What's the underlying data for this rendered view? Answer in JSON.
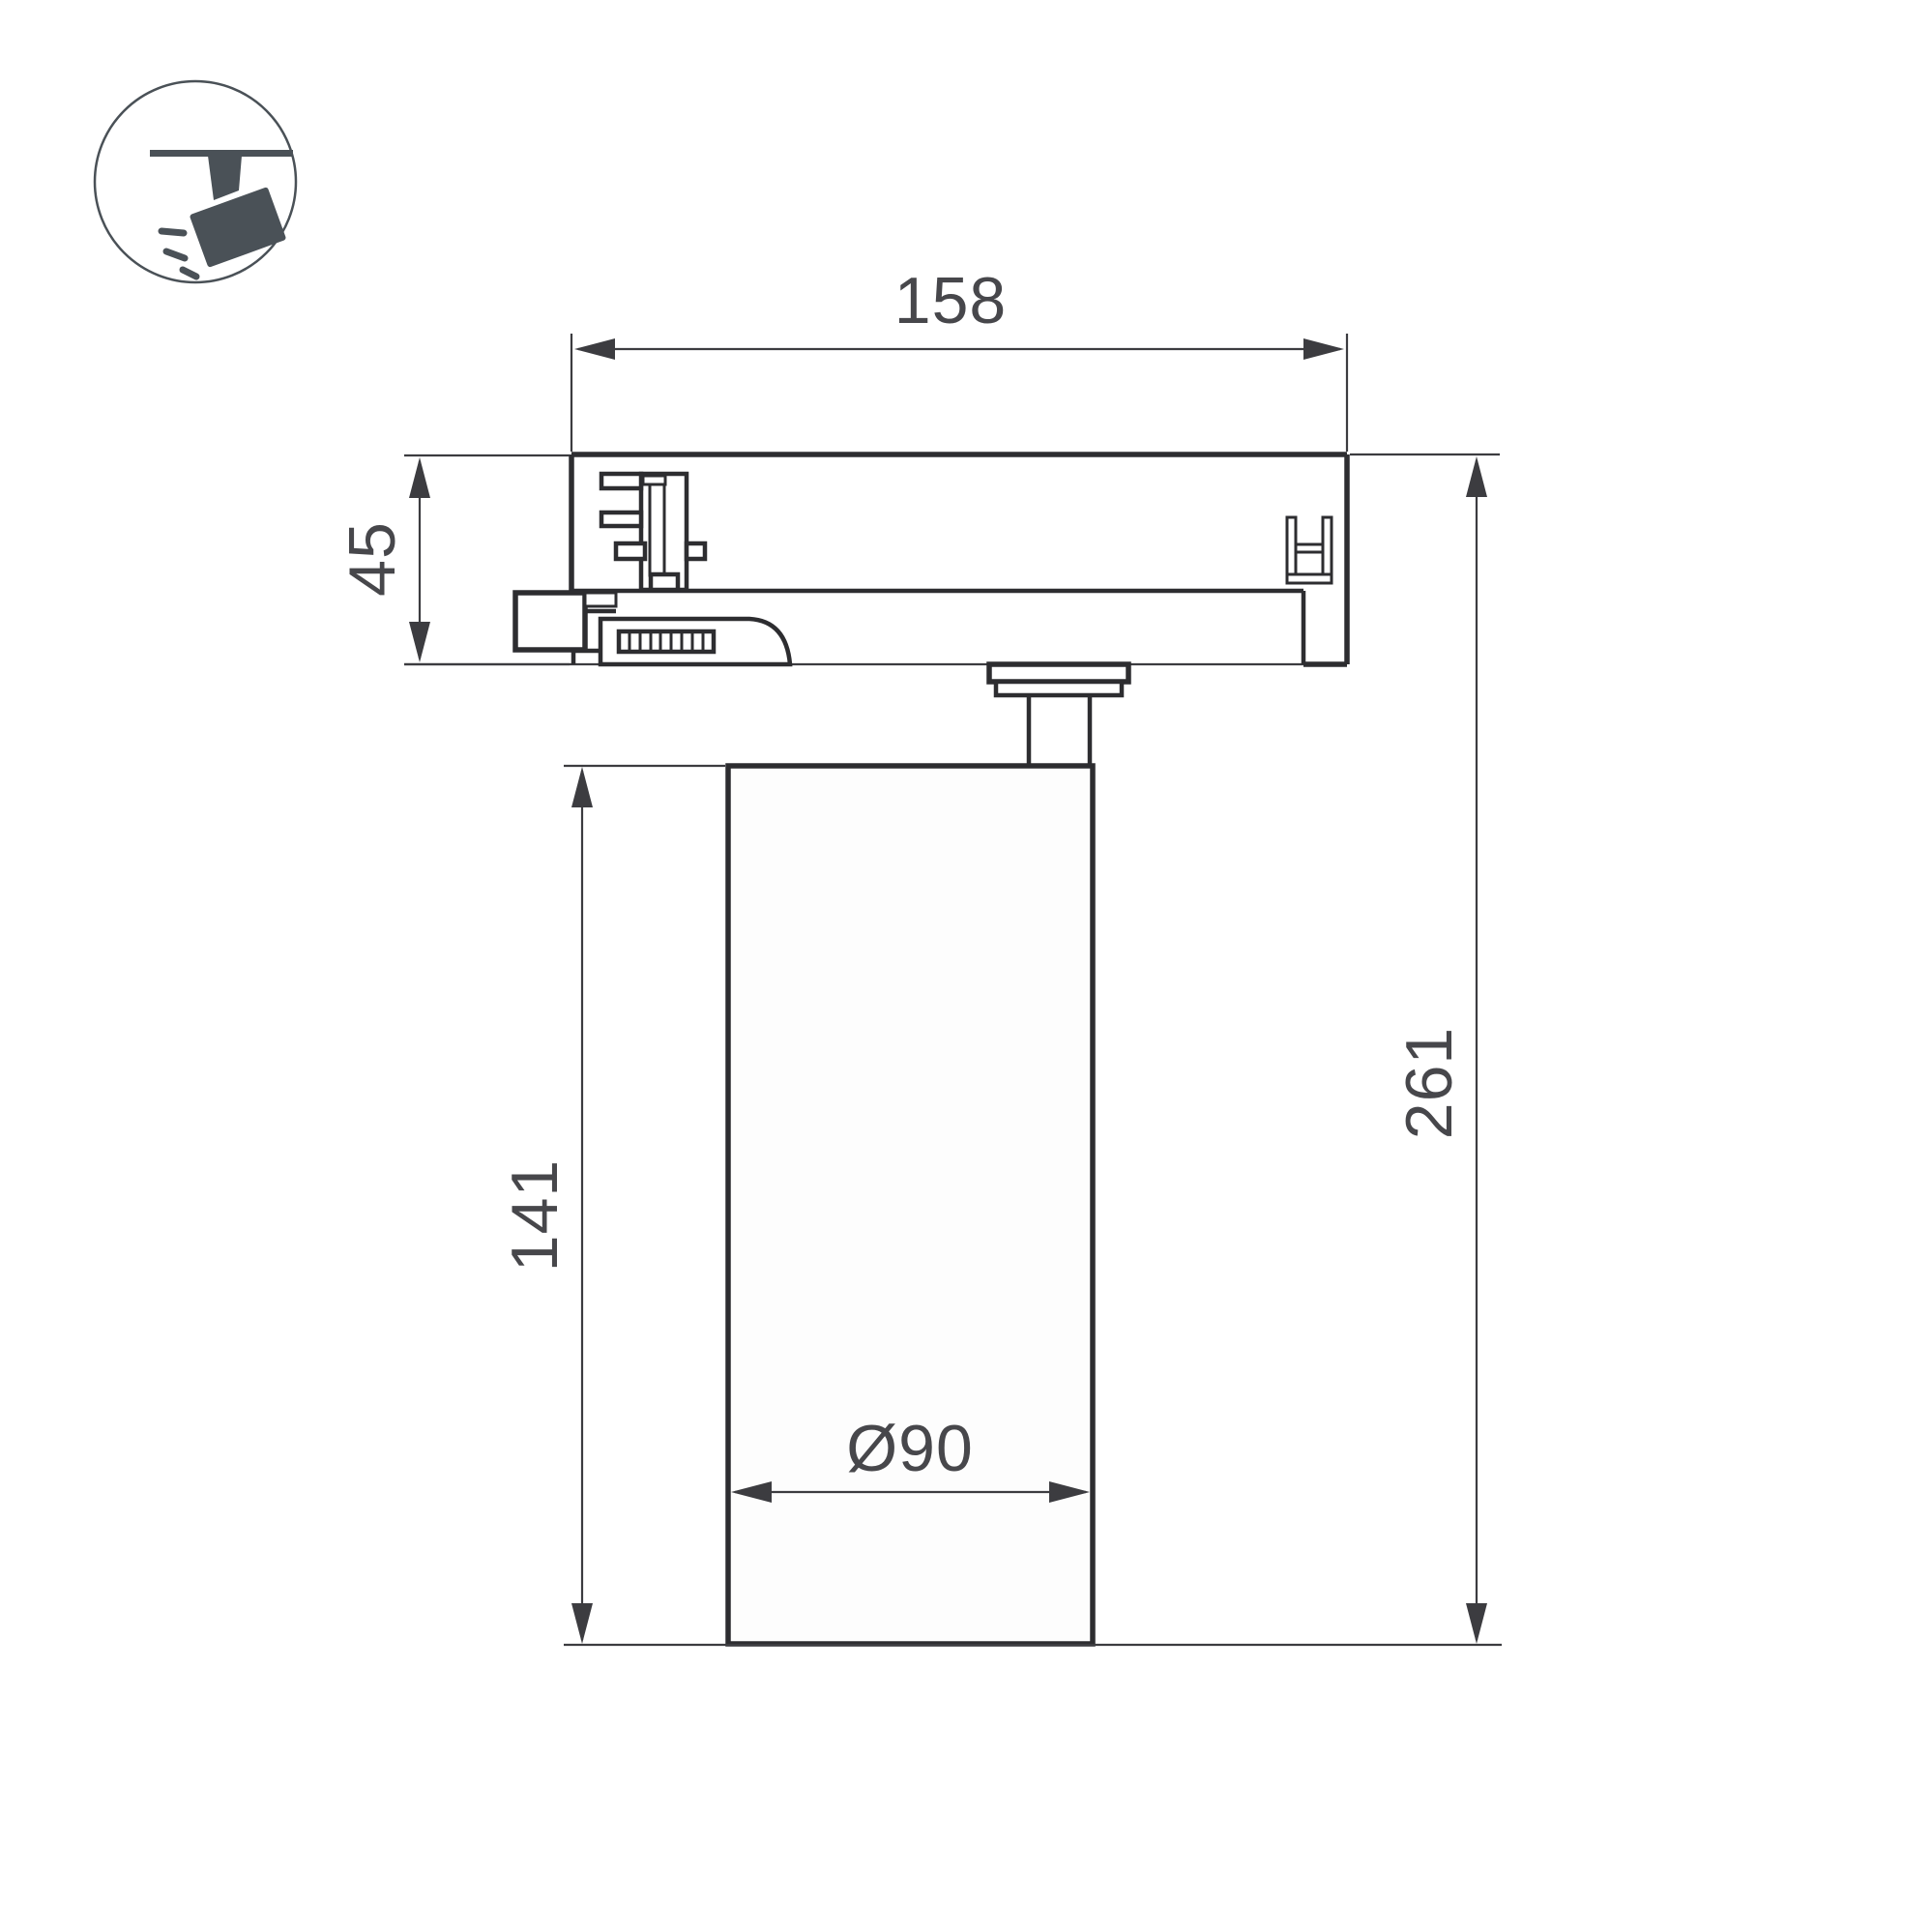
{
  "drawing": {
    "title": "track-spotlight-dimension-drawing",
    "labels": {
      "width": "158",
      "adapter_height": "45",
      "body_height": "141",
      "total_height": "261",
      "diameter": "Ø90"
    }
  },
  "icon": {
    "name": "track-spotlight",
    "color": "#4a5157"
  },
  "colors": {
    "background": "#ffffff",
    "object_line": "#2d2d30",
    "dimension_line": "#3c3c40",
    "label_text": "#47474b"
  }
}
